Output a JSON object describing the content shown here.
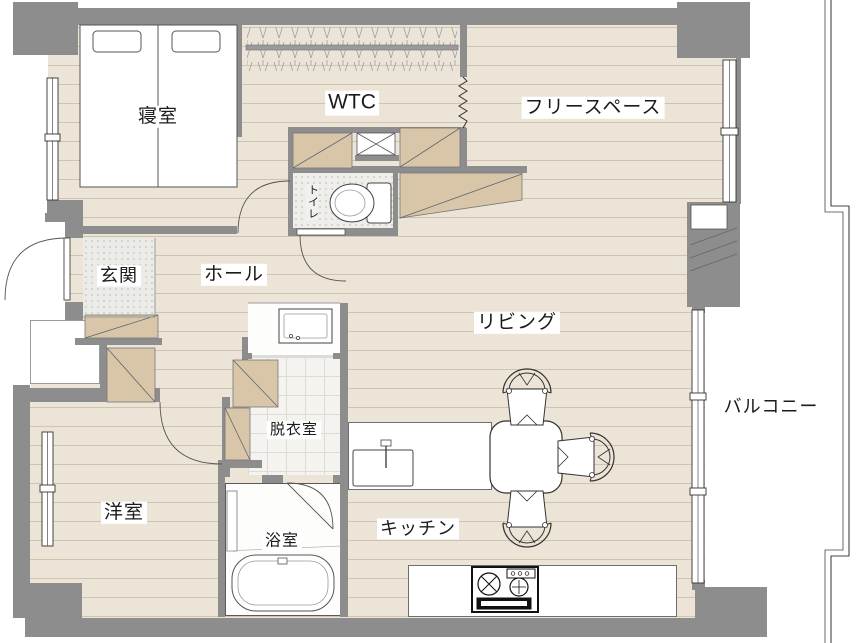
{
  "document": {
    "type": "floor-plan",
    "language": "ja"
  },
  "rooms": [
    {
      "id": "bedroom",
      "label": "寝室"
    },
    {
      "id": "wtc",
      "label": "WTC"
    },
    {
      "id": "free-space",
      "label": "フリースペース"
    },
    {
      "id": "toilet",
      "label": "トイレ"
    },
    {
      "id": "entrance",
      "label": "玄関"
    },
    {
      "id": "hall",
      "label": "ホール"
    },
    {
      "id": "living",
      "label": "リビング"
    },
    {
      "id": "balcony",
      "label": "バルコニー"
    },
    {
      "id": "dressing-room",
      "label": "脱衣室"
    },
    {
      "id": "western-room",
      "label": "洋室"
    },
    {
      "id": "bathroom",
      "label": "浴室"
    },
    {
      "id": "kitchen",
      "label": "キッチン"
    }
  ],
  "fixtures": [
    "double-bed",
    "hanger-rack",
    "accordion-curtain",
    "toilet",
    "washbasin",
    "bathtub",
    "kitchen-sink",
    "gas-stove",
    "dining-table",
    "chair",
    "closet",
    "window",
    "door-arc",
    "balcony-railing"
  ],
  "colors": {
    "wall": "#8d8d8d",
    "floor": "#ece4d7",
    "floor_line": "#ab9c82",
    "closet": "#d9c6a8",
    "tile": "#f4f3ef",
    "outline": "#444444"
  }
}
